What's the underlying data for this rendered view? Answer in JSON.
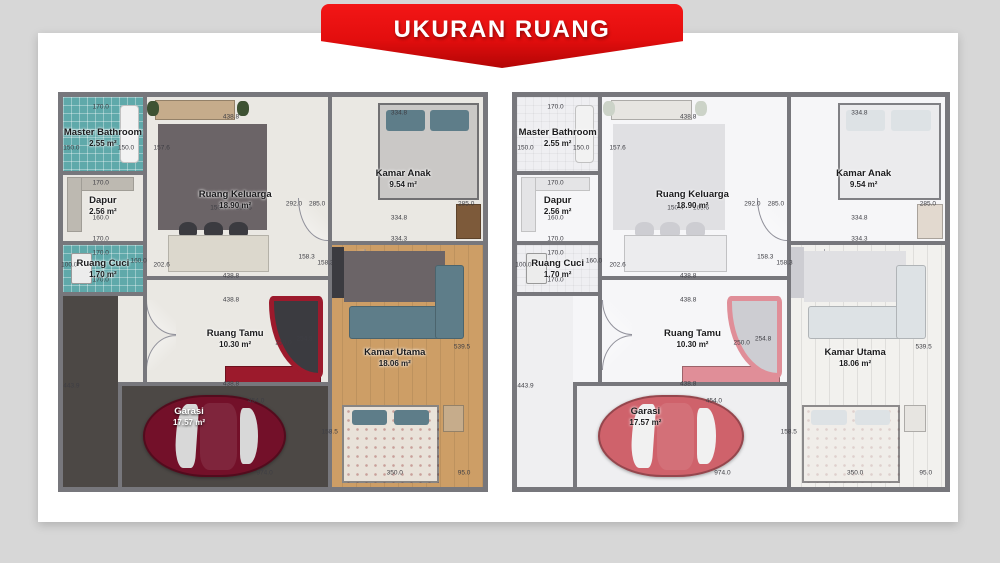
{
  "banner": {
    "label": "UKURAN RUANG",
    "bg_color": "#e30e0e",
    "text_color": "#ffffff"
  },
  "rooms": {
    "master_bathroom": {
      "name": "Master Bathroom",
      "area": "2.55 m²"
    },
    "dapur": {
      "name": "Dapur",
      "area": "2.56 m²"
    },
    "ruang_cuci": {
      "name": "Ruang Cuci",
      "area": "1.70 m²"
    },
    "ruang_keluarga": {
      "name": "Ruang Keluarga",
      "area": "18.90 m²"
    },
    "kamar_anak": {
      "name": "Kamar Anak",
      "area": "9.54 m²"
    },
    "ruang_tamu": {
      "name": "Ruang Tamu",
      "area": "10.30 m²"
    },
    "kamar_utama": {
      "name": "Kamar Utama",
      "area": "18.06 m²"
    },
    "garasi": {
      "name": "Garasi",
      "area": "17.57 m²"
    }
  },
  "dimension_labels": [
    {
      "t": "170.0",
      "x": 9,
      "y": 2.5
    },
    {
      "t": "438.8",
      "x": 40,
      "y": 5
    },
    {
      "t": "334.8",
      "x": 80,
      "y": 4
    },
    {
      "t": "150.0",
      "x": 2,
      "y": 13
    },
    {
      "t": "150.0",
      "x": 15,
      "y": 13
    },
    {
      "t": "157.6",
      "x": 23.5,
      "y": 13
    },
    {
      "t": "292.0",
      "x": 55,
      "y": 27.5
    },
    {
      "t": "285.0",
      "x": 60.5,
      "y": 27.5
    },
    {
      "t": "285.0",
      "x": 96,
      "y": 27.5
    },
    {
      "t": "170.0",
      "x": 9,
      "y": 22
    },
    {
      "t": "150.4",
      "x": 37,
      "y": 28.5
    },
    {
      "t": "165.6",
      "x": 43,
      "y": 28.5
    },
    {
      "t": "160.0",
      "x": 9,
      "y": 31
    },
    {
      "t": "170.0",
      "x": 9,
      "y": 36.5
    },
    {
      "t": "100.0",
      "x": 1.5,
      "y": 43
    },
    {
      "t": "160.0",
      "x": 18,
      "y": 42
    },
    {
      "t": "202.6",
      "x": 23.5,
      "y": 43
    },
    {
      "t": "170.0",
      "x": 9,
      "y": 40
    },
    {
      "t": "170.0",
      "x": 9,
      "y": 47
    },
    {
      "t": "438.8",
      "x": 40,
      "y": 46
    },
    {
      "t": "438.8",
      "x": 40,
      "y": 52
    },
    {
      "t": "334.8",
      "x": 80,
      "y": 31
    },
    {
      "t": "334.3",
      "x": 80,
      "y": 36.5
    },
    {
      "t": "158.3",
      "x": 58,
      "y": 41
    },
    {
      "t": "158.3",
      "x": 62.5,
      "y": 42.5
    },
    {
      "t": "250.0",
      "x": 52.5,
      "y": 63
    },
    {
      "t": "254.8",
      "x": 57.5,
      "y": 62
    },
    {
      "t": "539.5",
      "x": 95,
      "y": 64
    },
    {
      "t": "443.9",
      "x": 2,
      "y": 74
    },
    {
      "t": "454.0",
      "x": 46,
      "y": 78
    },
    {
      "t": "158.5",
      "x": 63.5,
      "y": 86
    },
    {
      "t": "438.8",
      "x": 40,
      "y": 73.5
    },
    {
      "t": "974.0",
      "x": 48,
      "y": 96.5
    },
    {
      "t": "350.0",
      "x": 79,
      "y": 96.5
    },
    {
      "t": "95.0",
      "x": 95.5,
      "y": 96.5
    }
  ]
}
